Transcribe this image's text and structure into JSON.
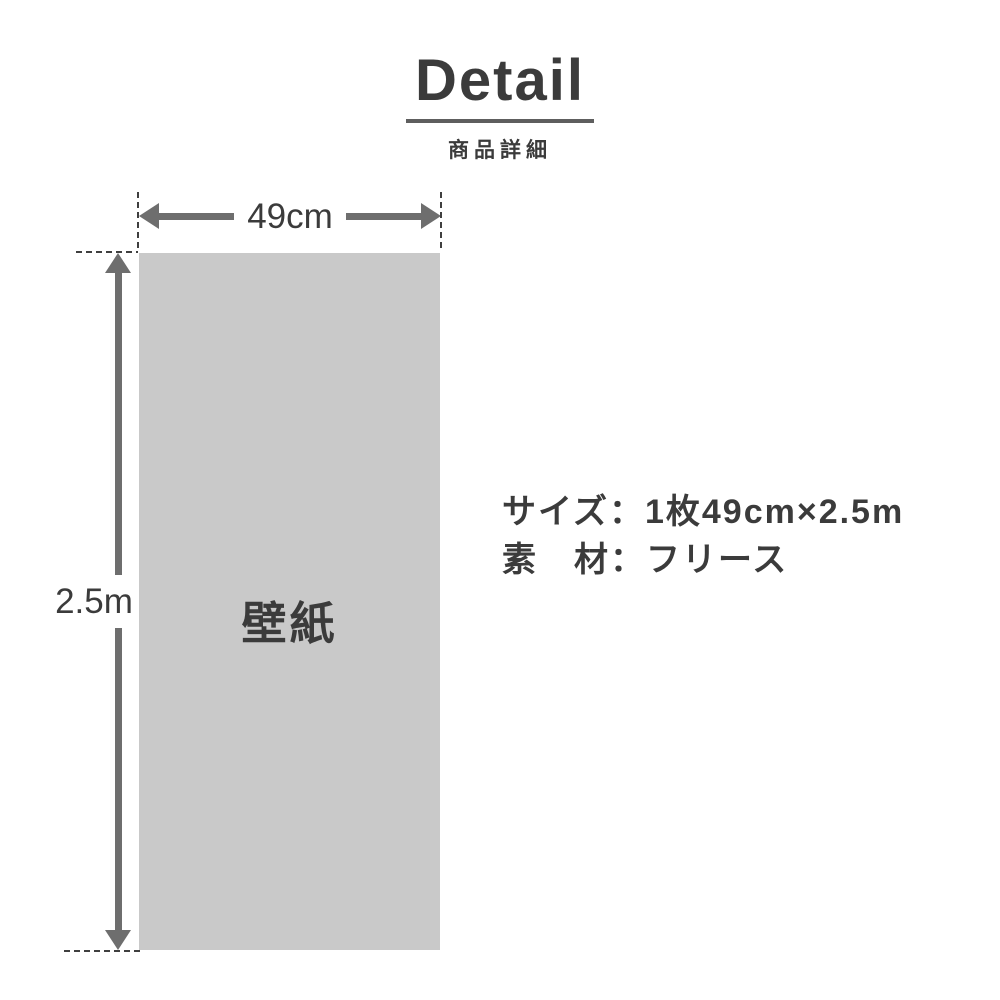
{
  "colors": {
    "background": "#ffffff",
    "ink": "#3b3b3b",
    "arrow": "#6e6e6e",
    "panel": "#c9c9c9",
    "guide": "#3f3f3f",
    "underline": "#5e5e5e"
  },
  "header": {
    "title": "Detail",
    "subtitle": "商品詳細"
  },
  "diagram": {
    "panel_label": "壁紙",
    "width_label": "49cm",
    "height_label": "2.5m"
  },
  "specs": {
    "size": "サイズ：1枚49cm×2.5m",
    "material": "素　材：フリース"
  }
}
